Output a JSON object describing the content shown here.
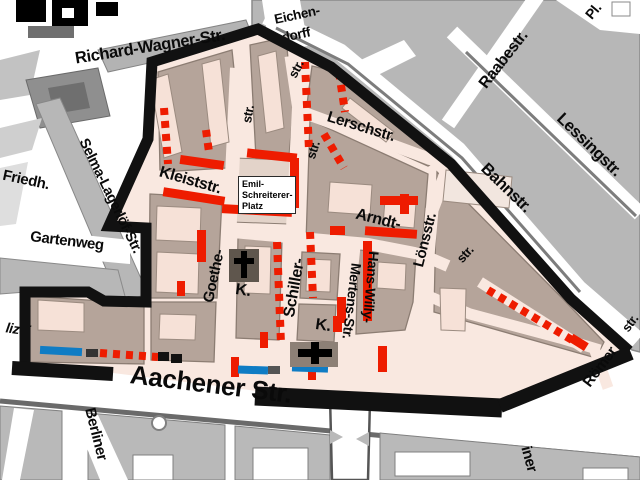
{
  "map": {
    "type": "city-district-map",
    "description": "Street map with black district boundary, red dashed parking markings, blue segments and church symbols",
    "colors": {
      "boundary": "#111111",
      "zone_street_pink": "#f9e8e0",
      "zone_block_mauve": "#b5a49a",
      "building_light": "#f6e1d7",
      "outside_block_gray": "#b7b7b7",
      "outside_street_white": "#ffffff",
      "marking_red": "#ee1c00",
      "marking_blue": "#0f7cc4",
      "church_symbol": "#000000"
    },
    "place_box": {
      "lines": [
        "Emil-",
        "Schreiterer-",
        "Platz"
      ]
    },
    "labels": [
      {
        "name": "label-richard-wagner-str",
        "text": "Richard-Wagner-Str.",
        "cx": 150,
        "cy": 47,
        "rot": -9,
        "size": 16.5,
        "layer": "over"
      },
      {
        "name": "label-eichendorff-line1",
        "text": "Eichen-",
        "cx": 297,
        "cy": 15,
        "rot": -12,
        "size": 13.5,
        "layer": "over"
      },
      {
        "name": "label-eichendorff-line2",
        "text": "dorff",
        "cx": 296,
        "cy": 35,
        "rot": -12,
        "size": 13.5,
        "layer": "under"
      },
      {
        "name": "label-eichendorffstr-fragment",
        "text": "str.",
        "cx": 296,
        "cy": 69,
        "rot": -62,
        "size": 13,
        "layer": "over"
      },
      {
        "name": "label-raabestr",
        "text": "Raabestr.",
        "cx": 504,
        "cy": 60,
        "rot": -52,
        "size": 16,
        "layer": "over"
      },
      {
        "name": "label-platz-abbrev",
        "text": "Pl.",
        "cx": 593,
        "cy": 11,
        "rot": -50,
        "size": 14,
        "layer": "over"
      },
      {
        "name": "label-lessingstr",
        "text": "Lessingstr.",
        "cx": 589,
        "cy": 145,
        "rot": 44,
        "size": 16.5,
        "layer": "over"
      },
      {
        "name": "label-bahnstr",
        "text": "Bahnstr.",
        "cx": 506,
        "cy": 188,
        "rot": 44,
        "size": 16.5,
        "layer": "over"
      },
      {
        "name": "label-lerschstr",
        "text": "Lerschstr.",
        "cx": 361,
        "cy": 127,
        "rot": 17,
        "size": 15.5,
        "layer": "over"
      },
      {
        "name": "label-kleiststr",
        "text": "Kleiststr.",
        "cx": 190,
        "cy": 181,
        "rot": 16,
        "size": 16,
        "layer": "over"
      },
      {
        "name": "label-selma-lagerloef-str",
        "text": "Selma-Lagerlöf-Str.",
        "cx": 110,
        "cy": 196,
        "rot": 64,
        "size": 14.5,
        "layer": "over"
      },
      {
        "name": "label-friedhof",
        "text": "Friedh.",
        "cx": 26,
        "cy": 180,
        "rot": 12,
        "size": 15,
        "layer": "over"
      },
      {
        "name": "label-gartenweg",
        "text": "Gartenweg",
        "cx": 67,
        "cy": 241,
        "rot": 7,
        "size": 15,
        "layer": "over"
      },
      {
        "name": "label-goethestr",
        "text": "Goethe-",
        "cx": 214,
        "cy": 276,
        "rot": -78,
        "size": 15,
        "layer": "over"
      },
      {
        "name": "label-goethestr-fragment",
        "text": "str.",
        "cx": 248,
        "cy": 114,
        "rot": -80,
        "size": 13,
        "layer": "over"
      },
      {
        "name": "label-schillerstr",
        "text": "Schiller-",
        "cx": 295,
        "cy": 288,
        "rot": -80,
        "size": 16,
        "layer": "over"
      },
      {
        "name": "label-schillerstr-fragment",
        "text": "str.",
        "cx": 313,
        "cy": 150,
        "rot": -72,
        "size": 13,
        "layer": "over"
      },
      {
        "name": "label-arndtstr",
        "text": "Arndt-",
        "cx": 378,
        "cy": 220,
        "rot": 14,
        "size": 16,
        "layer": "over"
      },
      {
        "name": "label-arndtstr-fragment",
        "text": "str.",
        "cx": 465,
        "cy": 254,
        "rot": -48,
        "size": 13,
        "layer": "over"
      },
      {
        "name": "label-loensstr",
        "text": "Lönsstr.",
        "cx": 425,
        "cy": 240,
        "rot": -76,
        "size": 15,
        "layer": "over"
      },
      {
        "name": "label-hans-willy",
        "text": "Hans-Willy-",
        "cx": 371,
        "cy": 287,
        "rot": 95,
        "size": 14,
        "layer": "over"
      },
      {
        "name": "label-mertens-str",
        "text": "Mertens-Str.",
        "cx": 352,
        "cy": 301,
        "rot": 97,
        "size": 14,
        "layer": "over"
      },
      {
        "name": "label-kirche-goethestr",
        "text": "K.",
        "cx": 243,
        "cy": 291,
        "rot": 8,
        "size": 16,
        "layer": "over"
      },
      {
        "name": "label-kirche-aachener",
        "text": "K.",
        "cx": 323,
        "cy": 326,
        "rot": 8,
        "size": 16,
        "layer": "over"
      },
      {
        "name": "label-aachener-str",
        "text": "Aachener Str.",
        "cx": 211,
        "cy": 384,
        "rot": 7,
        "size": 26,
        "layer": "over"
      },
      {
        "name": "label-berliner",
        "text": "Berliner",
        "cx": 96,
        "cy": 434,
        "rot": 76,
        "size": 15,
        "layer": "over"
      },
      {
        "name": "label-polizei-fragment",
        "text": "lizei",
        "cx": 18,
        "cy": 329,
        "rot": 8,
        "size": 14,
        "italic": true,
        "layer": "under"
      },
      {
        "name": "label-roemerstr",
        "text": "Römer",
        "cx": 600,
        "cy": 367,
        "rot": -53,
        "size": 15,
        "layer": "over"
      },
      {
        "name": "label-roemerstr-fragment",
        "text": "str.",
        "cx": 630,
        "cy": 323,
        "rot": -53,
        "size": 13,
        "layer": "over"
      },
      {
        "name": "label-street-fragment-iner",
        "text": "iner",
        "cx": 529,
        "cy": 459,
        "rot": 75,
        "size": 15,
        "layer": "over"
      }
    ]
  }
}
